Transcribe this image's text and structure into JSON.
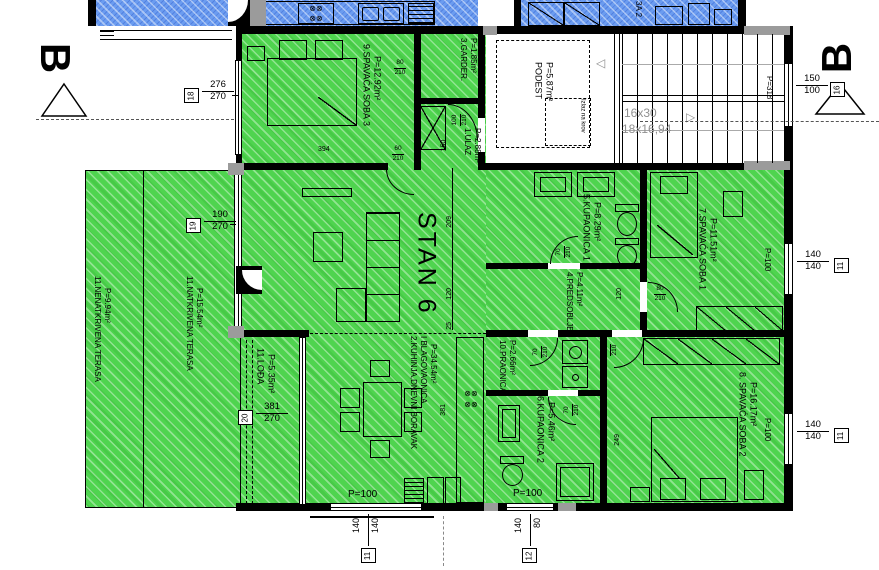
{
  "section": {
    "label": "B"
  },
  "apartment": {
    "label": "STAN 6"
  },
  "rooms": {
    "soba3": {
      "name": "9.SPAVAĆA SOBA 3",
      "area": "P=12.92m²"
    },
    "garder": {
      "name": "3.GARDER.",
      "area": "P=1.85m²"
    },
    "ulaz": {
      "name": "1.ULAZ",
      "area": "P=2.88m²"
    },
    "kupaonica1": {
      "name": "5.KUPAONICA 1",
      "area": "P=8.29m²"
    },
    "predsoblje": {
      "name": "4.PREDSOBLJE",
      "area": "P=4.11m²"
    },
    "soba1": {
      "name": "7.SPAVAĆA SOBA 1",
      "area": "P=11.51m²"
    },
    "kuhinja": {
      "name": "2.KUHINJA,DNEVNI BORAVAK",
      "name2": "I BLAGOVAONICA",
      "area": "P=34.54m²"
    },
    "praonica": {
      "name": "10.PRAONICA",
      "area": "P=2.66m²"
    },
    "kupaonica2": {
      "name": "6.KUPAONICA 2",
      "area": "P=5.46m²"
    },
    "soba2": {
      "name": "8. SPAVAĆA SOBA 2",
      "area": "P=16.17m²"
    },
    "loda": {
      "name": "11.LOĐA",
      "area": "P=5.35m²"
    },
    "natkrivena": {
      "name": "11.NATKRIVENA TERASA",
      "area": "P=15.54m²"
    },
    "nenatkrivena": {
      "name": "11.NENATKRIVENA TERASA",
      "area": "P=9.94m²"
    },
    "podest": {
      "name": "PODEST",
      "area": "P=5.87m²"
    },
    "blue_room": {
      "name": "3A 2"
    }
  },
  "stairs": {
    "dim1": "16x30",
    "dim2": "18x16,94",
    "roof_exit": "Izlaz na krov"
  },
  "windows": {
    "p100": "P=100",
    "p318": "P=318"
  },
  "dims": {
    "left_top": {
      "ref": "18",
      "over": "276",
      "under": "270"
    },
    "left_mid": {
      "ref": "19",
      "over": "190",
      "under": "270"
    },
    "loda": {
      "ref": "20",
      "over": "381",
      "under": "270"
    },
    "right_top": {
      "ref": "16",
      "over": "150",
      "under": "100"
    },
    "right_mid": {
      "ref": "11",
      "over": "140",
      "under": "140"
    },
    "right_bottom": {
      "ref": "11",
      "over": "140",
      "under": "140"
    },
    "bottom_left": {
      "ref": "11",
      "over": "140",
      "under": "140"
    },
    "bottom_right": {
      "ref": "12",
      "over": "140",
      "under": "80"
    }
  },
  "misc_dims": {
    "m394": "394",
    "m381": "381",
    "m249": "249",
    "m209": "209",
    "m120": "120",
    "m25": "25"
  },
  "doors": {
    "soba3": {
      "w": "60",
      "h": "210"
    },
    "garder": {
      "w": "80",
      "h": "210"
    },
    "ulaz": {
      "w": "100",
      "h": "210"
    },
    "ulaz_clear": "150",
    "kupaonica1": {
      "w": "70",
      "h": "210"
    },
    "predsoblje": {
      "w": "80",
      "h": "210"
    },
    "praonica": {
      "w": "70",
      "h": "210"
    },
    "kupaonica2": {
      "w": "70",
      "h": "210"
    },
    "soba2": {
      "w": "80",
      "h": "210"
    }
  },
  "colors": {
    "green": "#4fd44f",
    "blue": "#6b9cf0",
    "wall": "#000000",
    "column": "#9b9b9b",
    "gray_label": "#909090"
  }
}
